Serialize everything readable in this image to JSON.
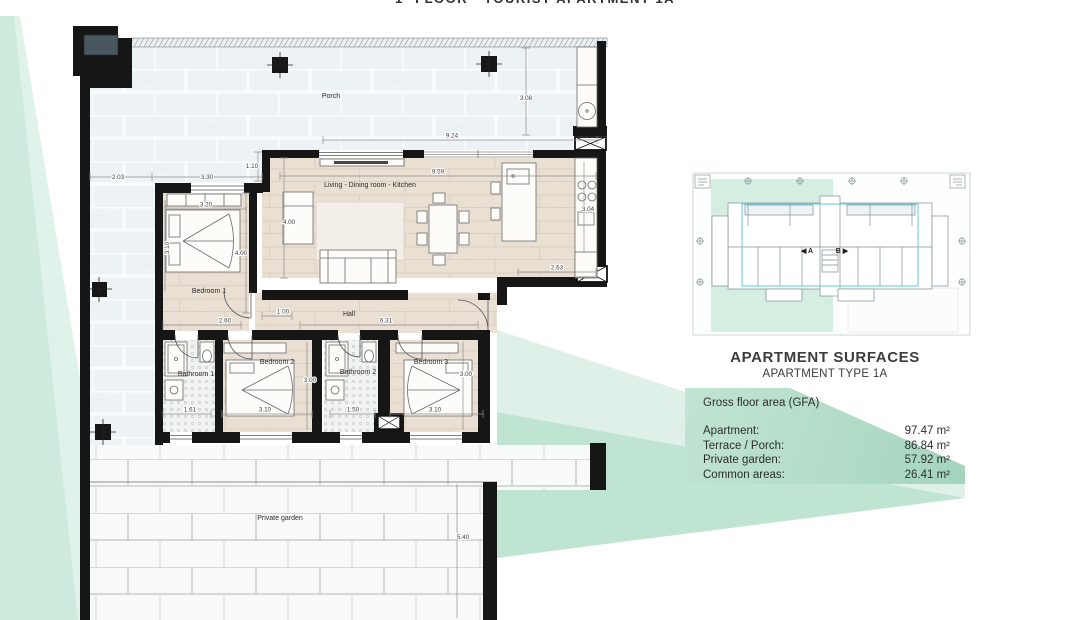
{
  "title": "1ª FLOOR · TOURIST APARTMENT 1A",
  "plan": {
    "rooms": [
      "Porch",
      "Living - Dining room - Kitchen",
      "Bedroom 1",
      "Hall",
      "Bathroom 1",
      "Bedroom 2",
      "Bathroom 2",
      "Bedroom 3",
      "Private garden"
    ],
    "dims": [
      "2.03",
      "3.30",
      "1.10",
      "9.24",
      "3.08",
      "9.59",
      "3.20",
      "4.00",
      "4.00",
      "3.10",
      "3.04",
      "2.63",
      "2.60",
      "1.00",
      "6.31",
      "1.61",
      "3.10",
      "3.00",
      "1.50",
      "3.10",
      "3.00",
      "5.40"
    ]
  },
  "key_plan": {
    "unit_a": "◀ A",
    "unit_b": "B ▶"
  },
  "surfaces": {
    "title": "APARTMENT SURFACES",
    "subtitle": "APARTMENT TYPE 1A",
    "section": "Gross floor area (GFA)",
    "rows": [
      {
        "label": "Apartment:",
        "value": "97.47 m²"
      },
      {
        "label": "Terrace / Porch:",
        "value": "86.84 m²"
      },
      {
        "label": "Private garden:",
        "value": "57.92 m²"
      },
      {
        "label": "Common areas:",
        "value": "26.41 m²"
      }
    ]
  },
  "colors": {
    "mint": "#cdeadc",
    "mint_light": "#e0f3ea",
    "ribbon_light": "#def0e7",
    "ribbon_medium": "#bfe4d1",
    "panel_green": "#b2dcc8",
    "highlight_cyan": "#5fc8d7",
    "wall_black": "#161616"
  }
}
